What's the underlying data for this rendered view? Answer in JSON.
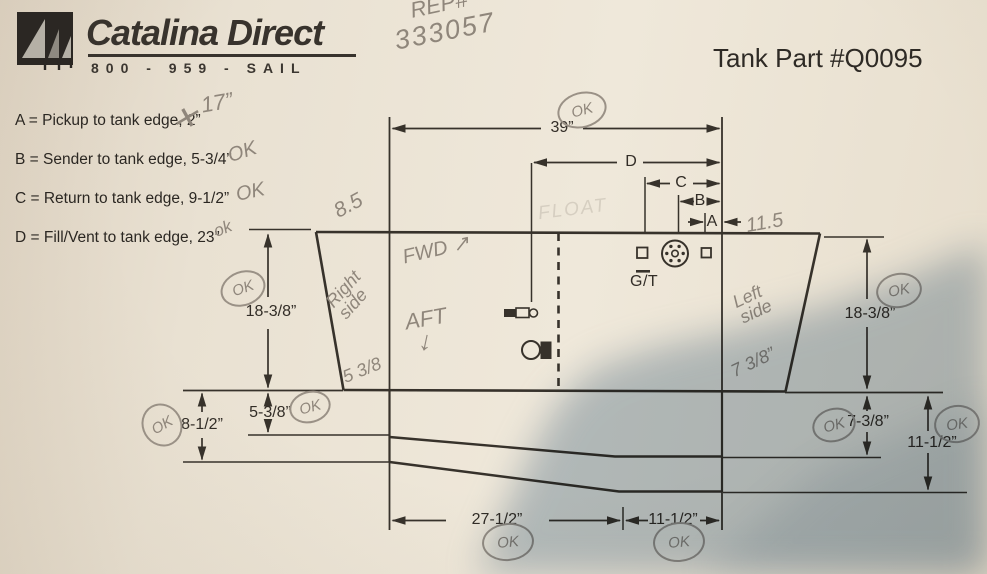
{
  "header": {
    "brand": "Catalina Direct",
    "phone": "800 - 959 - SAIL",
    "part_title": "Tank Part #Q0095"
  },
  "handwritten_top": {
    "rep_label": "REP#",
    "rep_number": "333057"
  },
  "legend": {
    "line_a": "A = Pickup to tank edge, 2”",
    "line_b": "B = Sender to tank edge, 5-3/4”",
    "line_c": "C = Return to tank edge, 9-1/2”",
    "line_d": "D = Fill/Vent to tank edge, 23”"
  },
  "diagram": {
    "dim_total_width": "39”",
    "dim_d": "D",
    "dim_c": "C",
    "dim_b": "B",
    "dim_a": "A",
    "dim_left_height": "18-3/8”",
    "dim_right_height": "18-3/8”",
    "dim_left_step": "5-3/8”",
    "dim_left_depth": "8-1/2”",
    "dim_right_step": "7-3/8”",
    "dim_right_depth": "11-1/2”",
    "dim_bottom_left": "27-1/2”",
    "dim_bottom_right": "11-1/2”",
    "sender_label": "G/T"
  },
  "handwritten": {
    "cross_mark": "✕",
    "pickup_correction": "17”",
    "meas_85": "8.5",
    "meas_115": "11.5",
    "fwd": "FWD ↗",
    "aft": "AFT",
    "aft_arrow": "↓",
    "right_side": "Right\nside",
    "left_side": "Left\nside",
    "float_note": "FLOAT",
    "left_step_note": "5 3/8",
    "right_step_note": "7 3/8”",
    "ok_marks": {
      "b": "OK",
      "c": "OK",
      "d": "ok",
      "top": "OK",
      "left_height": "OK",
      "right_height": "OK",
      "far_left": "OK",
      "left_step": "OK",
      "right_step": "OK",
      "right_depth": "OK",
      "bottom_left": "OK",
      "bottom_right": "OK"
    }
  },
  "colors": {
    "paper": "#e9e1d2",
    "ink": "#37322b",
    "pencil": "#8f867b",
    "shadow": "#7b95ae"
  }
}
